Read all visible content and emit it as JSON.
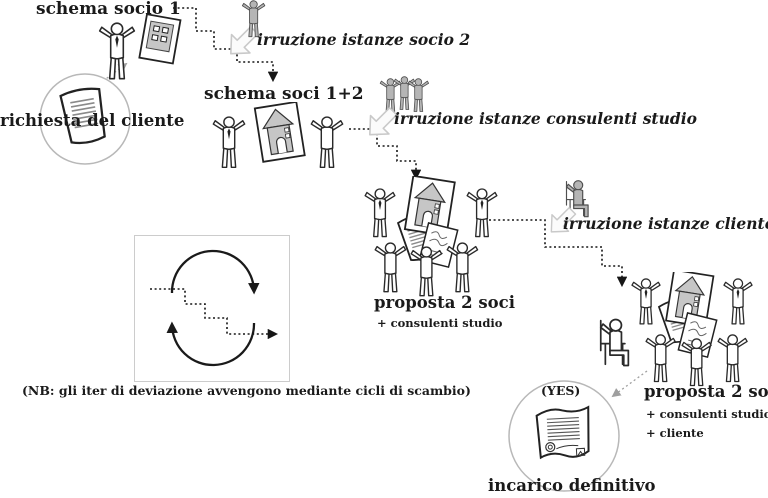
{
  "diagram": {
    "input": {
      "label": "richiesta del cliente"
    },
    "stages": [
      {
        "label": "schema socio 1",
        "sub": []
      },
      {
        "label": "schema soci 1+2",
        "sub": []
      },
      {
        "label": "proposta 2 soci",
        "sub": [
          "+ consulenti studio"
        ]
      },
      {
        "label": "proposta 2 soci",
        "sub": [
          "+ consulenti studio",
          "+ cliente"
        ]
      }
    ],
    "irruzioni": [
      {
        "label": "irruzione istanze socio 2"
      },
      {
        "label": "irruzione istanze consulenti studio"
      },
      {
        "label": "irruzione istanze cliente"
      }
    ],
    "outcome": {
      "badge": "(YES)",
      "label": "incarico definitivo"
    },
    "note": "(NB: gli iter di deviazione avvengono mediante cicli di scambio)",
    "icons": {
      "input": "client-request-document-icon",
      "stage1": "partner-with-schema-icon",
      "irruzione1": "partner2-figure-icon",
      "irruzione2": "consultants-group-icon",
      "irruzione3": "client-on-chair-icon",
      "insertion": "insertion-block-arrow-icon",
      "stage2": "two-partners-schema-icon",
      "stage3": "proposal-group-icon",
      "stage4": "full-group-with-client-icon",
      "outcome": "signed-contract-icon",
      "legend": "exchange-cycle-icon"
    },
    "colors": {
      "figure_gray": "#b5b5b5",
      "outline": "#1a1a1a",
      "light_gray": "#c9c9c9",
      "dotted": "#161616"
    }
  }
}
